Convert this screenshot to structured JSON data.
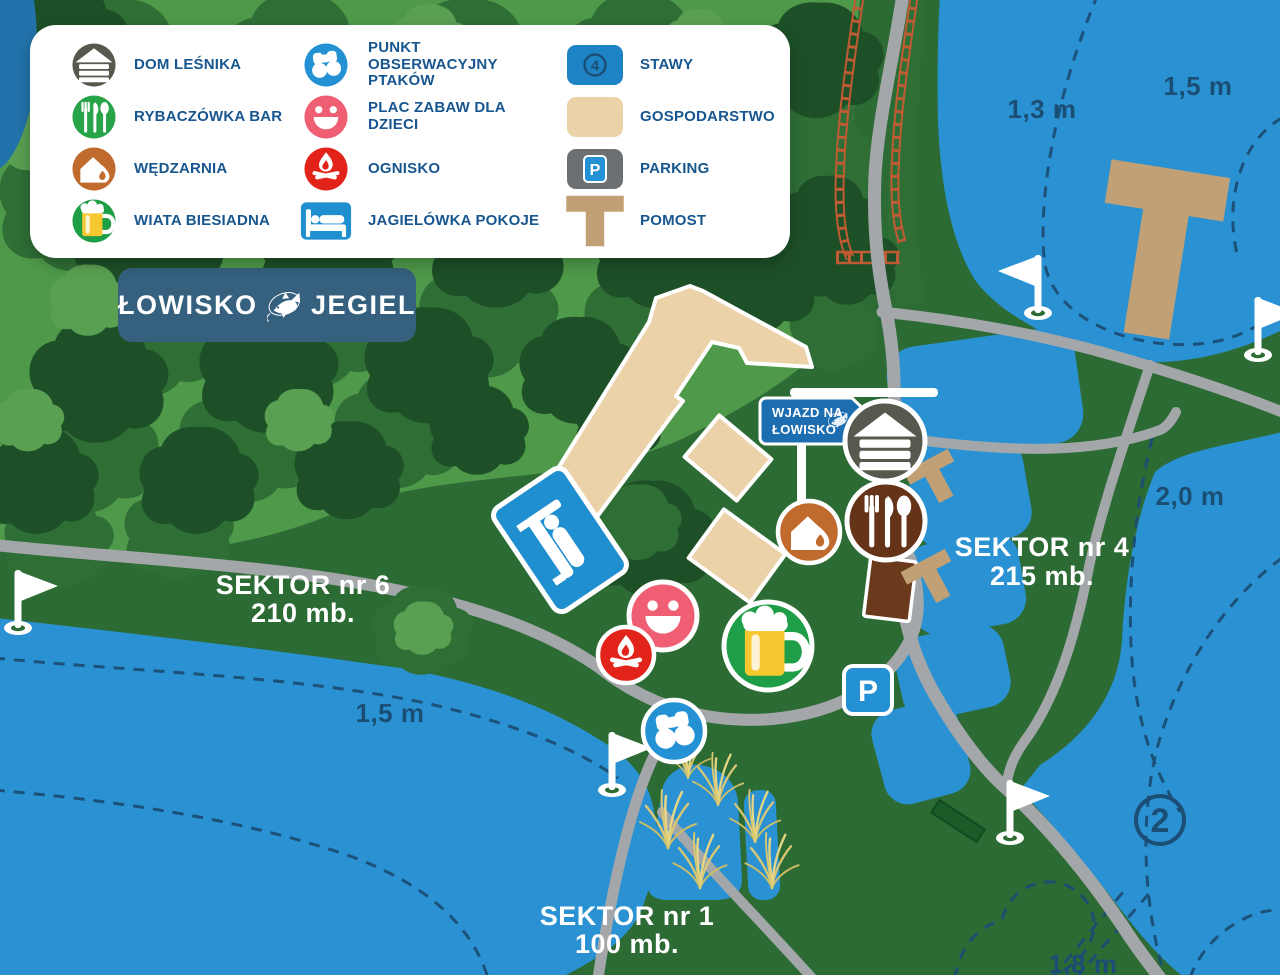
{
  "legend": {
    "col1": [
      {
        "icon": "cabin-icon",
        "label": "DOM LEŚNIKA",
        "color": "#57594e"
      },
      {
        "icon": "cutlery-icon",
        "label": "RYBACZÓWKA BAR",
        "color": "#27a348"
      },
      {
        "icon": "smokehouse-icon",
        "label": "WĘDZARNIA",
        "color": "#c06a2d"
      },
      {
        "icon": "beer-mug-icon",
        "label": "WIATA BIESIADNA",
        "color": "#1f9e48"
      }
    ],
    "col2": [
      {
        "icon": "binoculars-icon",
        "line1": "PUNKT OBSERWACYJNY",
        "line2": "PTAKÓW",
        "color": "#2491d4"
      },
      {
        "icon": "smiley-icon",
        "label": "PLAC ZABAW DLA DZIECI",
        "color": "#ef5e72"
      },
      {
        "icon": "campfire-icon",
        "label": "OGNISKO",
        "color": "#e2231a"
      },
      {
        "icon": "bed-icon",
        "label": "JAGIELÓWKA POKOJE",
        "color": "#1f8fd0"
      }
    ],
    "col3": [
      {
        "icon": "pond-swatch",
        "label": "STAWY",
        "badge": "4",
        "color": "#1e83c4"
      },
      {
        "icon": "farm-swatch",
        "label": "GOSPODARSTWO",
        "color": "#ecd2a8"
      },
      {
        "icon": "parking-swatch",
        "label": "PARKING",
        "badge": "P",
        "color": "#6d7072"
      },
      {
        "icon": "pier-swatch",
        "label": "POMOST",
        "color": "#c2a075"
      }
    ]
  },
  "banner": {
    "word1": "ŁOWISKO",
    "word2": "JEGIEL"
  },
  "map": {
    "entrance_sign": {
      "line1": "WJAZD NA",
      "line2": "ŁOWISKO"
    },
    "sectors": {
      "sector6": {
        "line1": "SEKTOR nr 6",
        "line2": "210 mb."
      },
      "sector4": {
        "line1": "SEKTOR nr 4",
        "line2": "215 mb."
      },
      "sector1": {
        "line1": "SEKTOR nr 1",
        "line2": "100 mb."
      }
    },
    "depths": {
      "d1": "1,3 m",
      "d2": "1,5 m",
      "d3": "2,0 m",
      "d4": "1,5 m",
      "d5": "1,8 m"
    },
    "pond_number": "2",
    "parking_letter": "P",
    "poi_icons": [
      "cabin-icon",
      "cutlery-icon",
      "smokehouse-icon",
      "beer-mug-icon",
      "smiley-icon",
      "campfire-icon",
      "binoculars-icon",
      "parking-sign",
      "bed-sign",
      "flag-marker",
      "pier",
      "entrance-sign"
    ]
  },
  "colors": {
    "water": "#2a92d3",
    "grass": "#2d6b35",
    "forest_dark": "#1d5027",
    "forest_mid": "#2f6f36",
    "forest_light": "#5aa053",
    "road": "#a4a7a9",
    "building_tan": "#ecd2a8",
    "pier_tan": "#c2a075",
    "label_navy": "#1b4e74",
    "legend_text": "#17568f",
    "banner_bg": "#35617e",
    "sign_blue": "#1d6db1",
    "railway": "#bf5b33",
    "beer_yellow": "#f6c72f"
  }
}
